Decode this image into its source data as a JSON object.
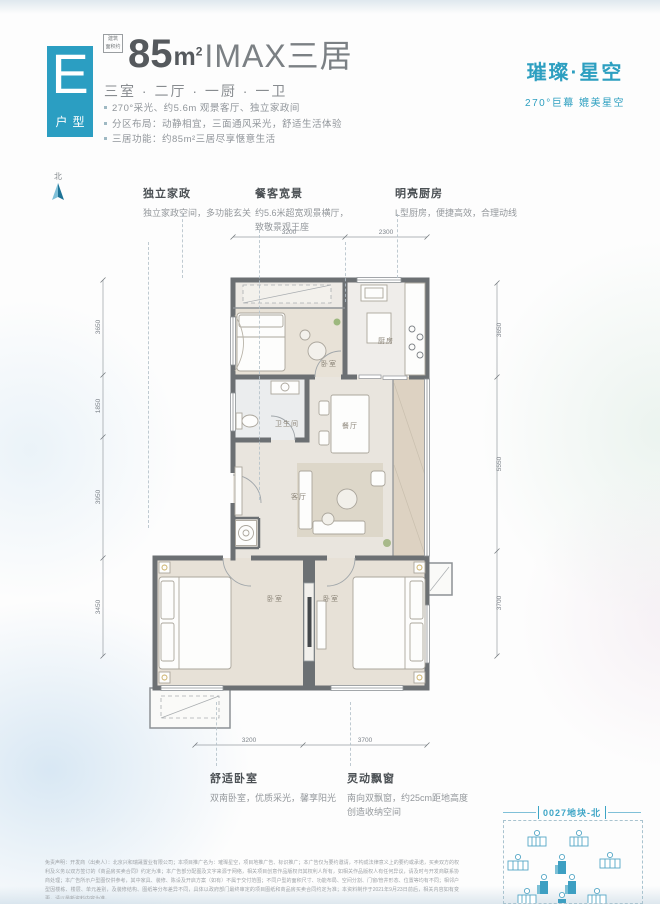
{
  "header": {
    "type_letter": "E",
    "type_label": "户型",
    "badge_line1": "建筑",
    "badge_line2": "面积约",
    "area_value": "85",
    "area_unit_base": "m",
    "area_unit_sup": "2",
    "area_suffix": "IMAX三居",
    "rooms_line": "三室 · 二厅 · 一厨 · 一卫",
    "bullets": [
      "270°采光、约5.6m 观景客厅、独立家政间",
      "分区布局：动静相宜，三面通风采光，舒适生活体验",
      "三居功能：约85m²三居尽享惬意生活"
    ]
  },
  "brand": {
    "title": "璀璨·星空",
    "subtitle": "270°巨幕 媲美星空",
    "accent": "#2d9fc0"
  },
  "compass": {
    "label": "北"
  },
  "features_top": [
    {
      "title": "独立家政",
      "desc": "独立家政空间，多功能玄关",
      "desc2": ""
    },
    {
      "title": "餐客宽景",
      "desc": "约5.6米超宽观景横厅，",
      "desc2": "致敬景观王座"
    },
    {
      "title": "明亮厨房",
      "desc": "L型厨房，便捷高效，合理动线",
      "desc2": ""
    }
  ],
  "features_bottom": [
    {
      "title": "舒适卧室",
      "desc": "双南卧室，优质采光，馨享阳光",
      "desc2": ""
    },
    {
      "title": "灵动飘窗",
      "desc": "南向双飘窗，约25cm距地高度",
      "desc2": "创造收纳空间"
    }
  ],
  "plan": {
    "rooms": [
      "卧室",
      "厨房",
      "餐厅",
      "卫生间",
      "客厅",
      "卧室",
      "卧室"
    ],
    "dims": {
      "top": [
        "3200",
        "2300"
      ],
      "bottom": [
        "3200",
        "3700"
      ],
      "left": [
        "3650",
        "1850",
        "3950",
        "3450"
      ],
      "right": [
        "3650",
        "5550",
        "3700"
      ]
    }
  },
  "sitemap": {
    "title": "0027地块-北"
  },
  "disclaimer": "免责声明：开发商（出卖人）：北京兴和瑞晟置业有限公司；本项目推广名为：璀璨星空，项目地推广告、标识推广；本广告仅为要约邀请，不构成法律意义上的要约或承诺，买卖双方的权利及义务以双方签订的《商品房买卖合同》约定为准；本广告部分配图及文字来源于网络，相关项目创意作品版权归其权利人所有，如相关作品版权人有任何异议，请及时与开发商联系协商处理；本广告所示户型图仅供参考，其中家具、装修、陈设及开启方案（如有）不属于交付范围；不同户型的面积尺寸、功能布局、空间分割、门窗/管井形态、位置等均有不同；相邻户型因楼栋、楼层、单元差别，及装修结构、图纸等分布差异不同，具体以政府部门最终审定的项目图纸和商品房买卖合同约定为准；本资料制作于2021年9月23日前后，相关内容如有变更，请以最新资料内容为准。"
}
